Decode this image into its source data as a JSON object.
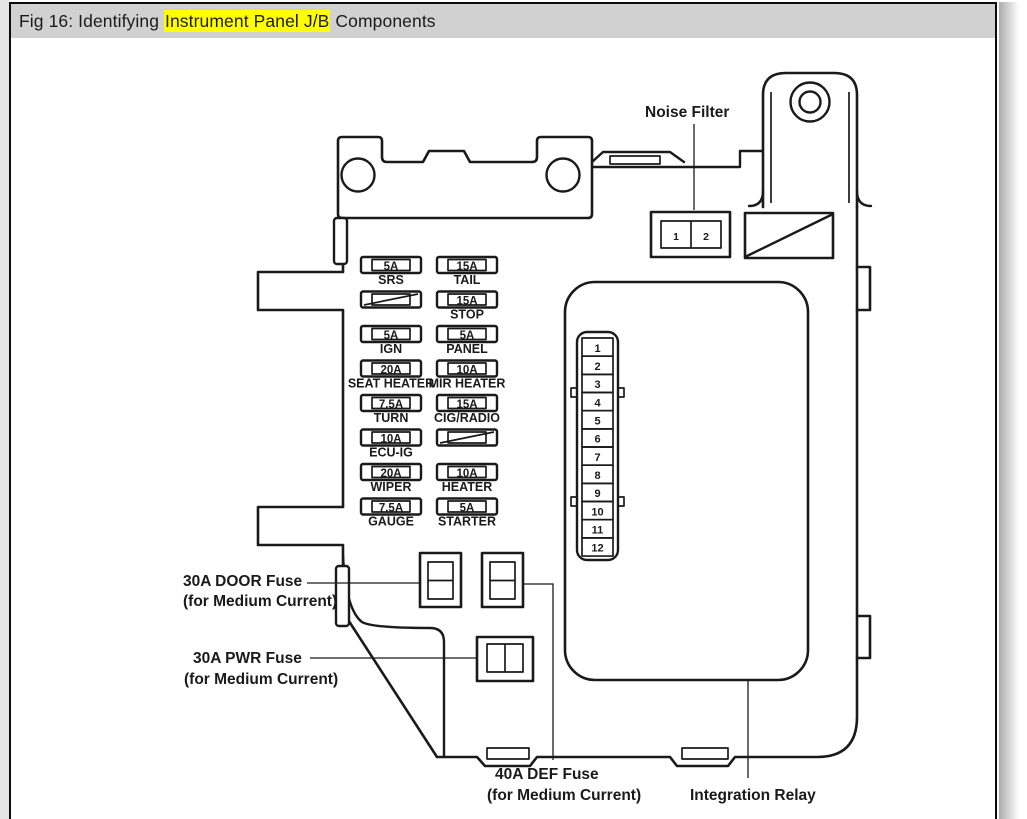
{
  "window": {
    "title_prefix": "Fig 16: Identifying ",
    "title_highlight": "Instrument Panel J/B",
    "title_suffix": " Components",
    "highlight_color": "#ffff00"
  },
  "diagram": {
    "noise_filter_label": "Noise Filter",
    "integration_relay_label": "Integration Relay",
    "door_fuse_label": [
      "30A DOOR Fuse",
      "(for Medium Current)"
    ],
    "pwr_fuse_label": [
      "30A PWR Fuse",
      "(for Medium Current)"
    ],
    "def_fuse_label": [
      "40A DEF Fuse",
      "(for Medium Current)"
    ],
    "noise_filter_pins": [
      "1",
      "2"
    ],
    "relay_pins": [
      "1",
      "2",
      "3",
      "4",
      "5",
      "6",
      "7",
      "8",
      "9",
      "10",
      "11",
      "12"
    ],
    "fuses_left": [
      {
        "amp": "5A",
        "name": "SRS",
        "hatched": false
      },
      {
        "amp": "",
        "name": "",
        "hatched": true
      },
      {
        "amp": "5A",
        "name": "IGN",
        "hatched": false
      },
      {
        "amp": "20A",
        "name": "SEAT HEATER",
        "hatched": false
      },
      {
        "amp": "7.5A",
        "name": "TURN",
        "hatched": false
      },
      {
        "amp": "10A",
        "name": "ECU-IG",
        "hatched": false
      },
      {
        "amp": "20A",
        "name": "WIPER",
        "hatched": false
      },
      {
        "amp": "7.5A",
        "name": "GAUGE",
        "hatched": false
      }
    ],
    "fuses_right": [
      {
        "amp": "15A",
        "name": "TAIL",
        "hatched": false
      },
      {
        "amp": "15A",
        "name": "STOP",
        "hatched": false
      },
      {
        "amp": "5A",
        "name": "PANEL",
        "hatched": false
      },
      {
        "amp": "10A",
        "name": "MIR HEATER",
        "hatched": false
      },
      {
        "amp": "15A",
        "name": "CIG/RADIO",
        "hatched": false
      },
      {
        "amp": "",
        "name": "",
        "hatched": true
      },
      {
        "amp": "10A",
        "name": "HEATER",
        "hatched": false
      },
      {
        "amp": "5A",
        "name": "STARTER",
        "hatched": false
      }
    ]
  }
}
